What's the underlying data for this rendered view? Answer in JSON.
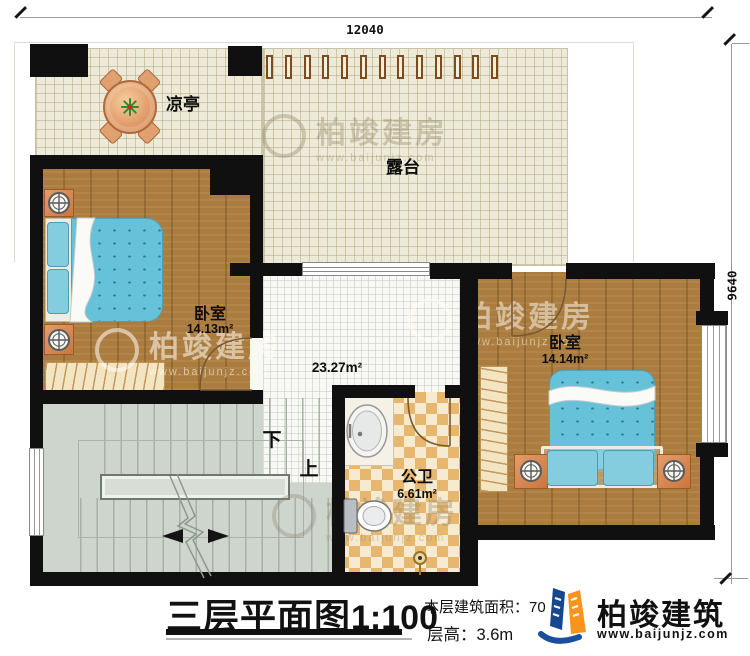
{
  "dimensions": {
    "top": "12040",
    "right": "9640"
  },
  "rooms": {
    "terrace": {
      "label": "露台"
    },
    "pavilion": {
      "label": "凉亭"
    },
    "bedroom1": {
      "label": "卧室",
      "area": "14.13m²"
    },
    "bedroom2": {
      "label": "卧室",
      "area": "14.14m²"
    },
    "bathroom": {
      "label": "公卫",
      "area": "6.61m²"
    },
    "hall": {
      "area": "23.27m²"
    }
  },
  "stairs": {
    "down": "下",
    "up": "上"
  },
  "title_block": {
    "title": "三层平面图",
    "scale": "1:100",
    "floor_area_label": "本层建筑面积：70",
    "floor_height_label": "层高：3.6m"
  },
  "brand": {
    "name": "柏竣建筑",
    "website": "www.baijunjz.com",
    "blue": "#1b4f9c",
    "orange": "#f7941d"
  },
  "watermark": {
    "name": "柏竣建房",
    "website": "www.baijunjz.com"
  }
}
